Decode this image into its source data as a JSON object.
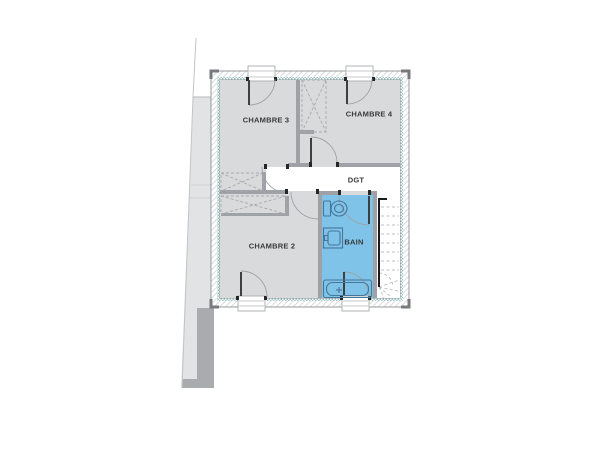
{
  "plan": {
    "type": "floor-plan",
    "rooms": [
      {
        "id": "chambre3",
        "label": "CHAMBRE 3"
      },
      {
        "id": "chambre4",
        "label": "CHAMBRE 4"
      },
      {
        "id": "degagement",
        "label": "DGT"
      },
      {
        "id": "chambre2",
        "label": "CHAMBRE 2"
      },
      {
        "id": "bain",
        "label": "BAIN"
      }
    ],
    "colors": {
      "room_fill": "#d9dadb",
      "bathroom_fill": "#7fc3e8",
      "wall": "#9ea1a5",
      "insulation_liner": "#9cc6c5",
      "hatch_line": "#c3c5c7",
      "label_text": "#3a3a3c",
      "fixture_outline": "#46769a",
      "adjacent_area": "#e2e3e4",
      "adjacent_wall": "#a9abae"
    }
  }
}
